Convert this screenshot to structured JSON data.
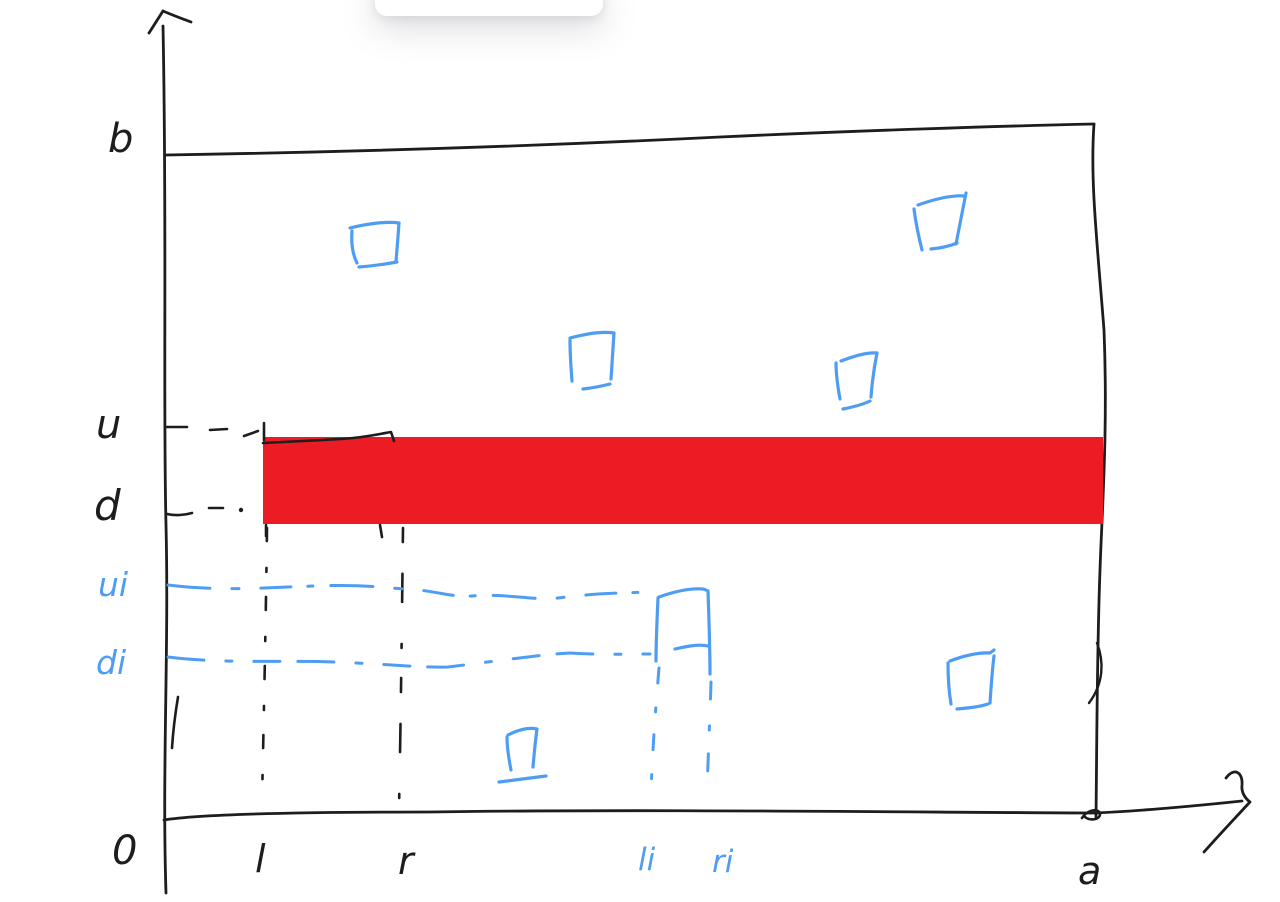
{
  "colors": {
    "ink": "#1d1d1f",
    "blue": "#4f9df3",
    "red": "#ec1c24",
    "bg": "#ffffff"
  },
  "labels": {
    "b": "b",
    "u": "u",
    "d": "d",
    "ui": "ui",
    "di": "di",
    "origin": "0",
    "l": "l",
    "r": "r",
    "li": "li",
    "ri": "ri",
    "a": "a"
  },
  "figure": {
    "type": "hand-drawn coordinate sketch",
    "outer_rect": {
      "width_label": "a",
      "height_label": "b"
    },
    "red_band": {
      "y_from": "d",
      "y_to": "u",
      "spans": "full width to a",
      "color": "#ec1c24"
    },
    "black_square_outline": {
      "x_from": "l",
      "x_to": "r",
      "y_from": "d",
      "y_to": "u"
    },
    "blue_guide_square": {
      "x_from": "li",
      "x_to": "ri",
      "y_from": "di",
      "y_to": "ui"
    },
    "blue_squares_count": 7
  }
}
